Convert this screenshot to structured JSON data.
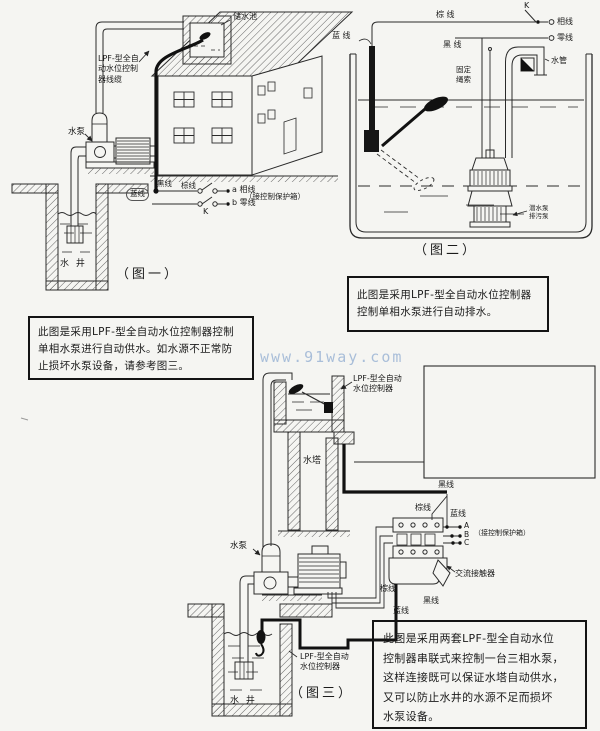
{
  "watermark": "www.91way.com",
  "fig1": {
    "caption": "（图一）",
    "labels": {
      "tank": "储水池",
      "cable": "LPF-型全自\n动水位控制\n器线缆",
      "pump": "水泵",
      "well": "水 井",
      "black_wire": "黑线",
      "brown_wire": "棕线",
      "blue_wire": "蓝线",
      "switch": "K",
      "phase": "a 相线",
      "neutral": "b 零线",
      "control_box": "（接控制保护箱）"
    }
  },
  "fig2": {
    "caption": "（图二）",
    "labels": {
      "brown_wire": "棕 线",
      "switch": "K",
      "phase": "相线",
      "neutral": "零线",
      "blue_wire": "蓝 线",
      "black_wire": "黑 线",
      "water_pipe": "水管",
      "rope": "固定\n绳索",
      "pump": "潜水泵\n排污泵"
    }
  },
  "fig3": {
    "caption": "（图三）",
    "labels": {
      "controller_top": "LPF-型全自动\n水位控制器",
      "tower": "水塔",
      "pump": "水泵",
      "black_top": "黑线",
      "brown_top": "棕线",
      "blue_top": "蓝线",
      "control_box": "（接控制保护箱）",
      "contactor": "交流接触器",
      "brown_bottom": "棕线",
      "blue_bottom": "蓝线",
      "black_bottom": "黑线",
      "controller_bottom": "LPF-型全自动\n水位控制器",
      "well": "水 井"
    },
    "terminals": [
      "A",
      "B",
      "C"
    ]
  },
  "notes": {
    "fig1_note": {
      "lines": [
        "此图是采用LPF-型全自动水位控制器控制",
        "单相水泵进行自动供水。如水源不正常防",
        "止损坏水泵设备，请参考图三。"
      ]
    },
    "fig2_note": {
      "lines": [
        "此图是采用LPF-型全自动水位控制器",
        "控制单相水泵进行自动排水。"
      ]
    },
    "fig3_note": {
      "lines": [
        "此图是采用两套LPF-型全自动水位",
        "控制器串联式来控制一台三相水泵，",
        "这样连接既可以保证水塔自动供水，",
        "又可以防止水井的水源不足而损坏",
        "水泵设备。"
      ]
    }
  }
}
